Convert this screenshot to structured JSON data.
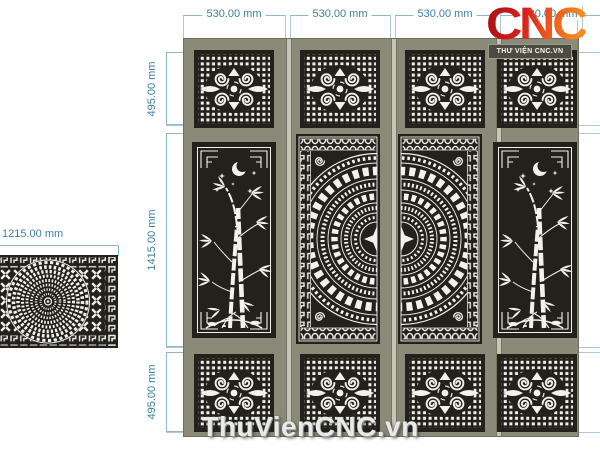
{
  "logo": {
    "text": "CNC",
    "badge": "THƯ VIỆN CNC.VN",
    "gradient_start": "#a50f16",
    "gradient_end": "#f58a1d"
  },
  "watermark": {
    "text": "ThuVienCNC.vn"
  },
  "dims": {
    "top": [
      "530.00 mm",
      "530.00 mm",
      "530.00 mm",
      "530.00 mm"
    ],
    "rows": [
      "495.00 mm",
      "1415.00 mm",
      "495.00 mm"
    ],
    "side": "1215.00 mm"
  },
  "motifs": {
    "small_panel": "swirl-grille",
    "left_leaf_panel": "bamboo-moon-stars",
    "center_panel": "bronze-drum-half",
    "side_panel": "mandala-diamond-lattice"
  },
  "colors": {
    "dimension_text": "#3f7fa5",
    "dimension_line": "#8fb8c9",
    "door_frame": "#8b8a78",
    "panel_black": "#22211b",
    "pattern_white": "#f2f1ea",
    "leaf_gap": "#c6c5b8"
  }
}
